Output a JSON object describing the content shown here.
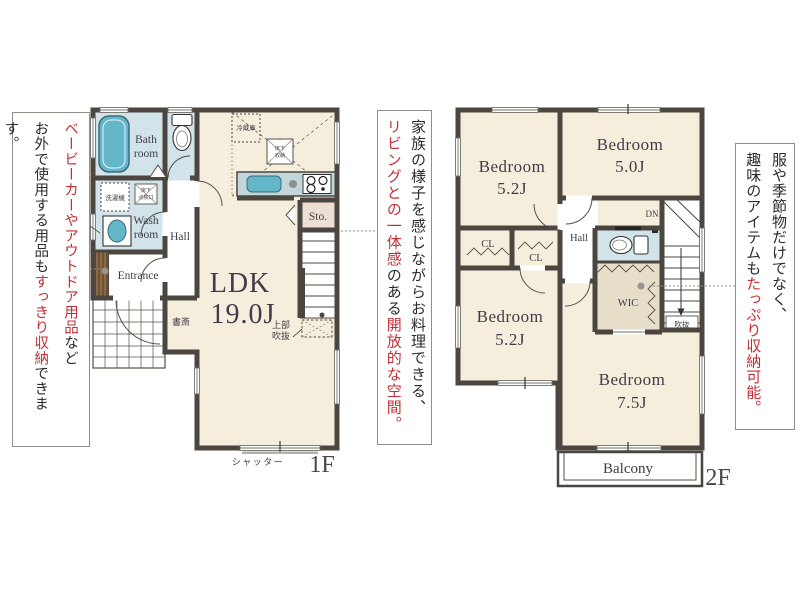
{
  "floor1": {
    "label": "1F",
    "ldk": "LDK",
    "ldk_size": "19.0J",
    "bath_line1": "Bath",
    "bath_line2": "room",
    "wash_line1": "Wash",
    "wash_line2": "room",
    "hall": "Hall",
    "entrance": "Entrance",
    "storage": "Sto.",
    "study": "書斎",
    "shutter": "シャッター",
    "upper_void_line1": "上部",
    "upper_void_line2": "吹抜",
    "ps": "PS",
    "washing_machine": "洗濯機",
    "hatch_line1": "床下",
    "hatch_line2": "点検口",
    "refrigerator": "冷蔵庫",
    "underfloor_line1": "床下",
    "underfloor_line2": "収納"
  },
  "floor2": {
    "label": "2F",
    "bedroom_tl": "Bedroom",
    "bedroom_tl_size": "5.2J",
    "bedroom_tr": "Bedroom",
    "bedroom_tr_size": "5.0J",
    "bedroom_bl": "Bedroom",
    "bedroom_bl_size": "5.2J",
    "bedroom_br": "Bedroom",
    "bedroom_br_size": "7.5J",
    "closet1": "CL",
    "closet2": "CL",
    "hall": "Hall",
    "wic": "WIC",
    "down": "DN",
    "void": "吹抜",
    "balcony": "Balcony"
  },
  "annotations": {
    "outdoor_storage": {
      "line1": [
        {
          "text": "ベービーカーやアウトドア用品"
        },
        {
          "text": "など"
        }
      ],
      "line2": [
        {
          "text": "お外で使用する用品も"
        },
        {
          "text": "すっきり収納"
        },
        {
          "text": "できます。"
        }
      ]
    },
    "kitchen_living": {
      "line1": [
        {
          "text": "家族の様子を感じながらお料理できる、"
        }
      ],
      "line2": [
        {
          "text": "リビングとの一体感"
        },
        {
          "text": "のある"
        },
        {
          "text": "開放的な空間。"
        }
      ]
    },
    "wic_storage": {
      "line1": [
        {
          "text": "服や季節物だけでなく、"
        }
      ],
      "line2": [
        {
          "text": "趣味のアイテムも"
        },
        {
          "text": "たっぷり収納可能。"
        }
      ]
    }
  },
  "colors": {
    "wall": "#4b463f",
    "floor": "#f6eedd",
    "wet_floor": "#d2e4e9",
    "wic_floor": "#e7dec9",
    "storage_floor": "#eedfd4",
    "fixture_blue": "#64b6c9",
    "counter": "#c3d7db",
    "accent_red": "#c22f36",
    "text": "#3f3d48"
  }
}
